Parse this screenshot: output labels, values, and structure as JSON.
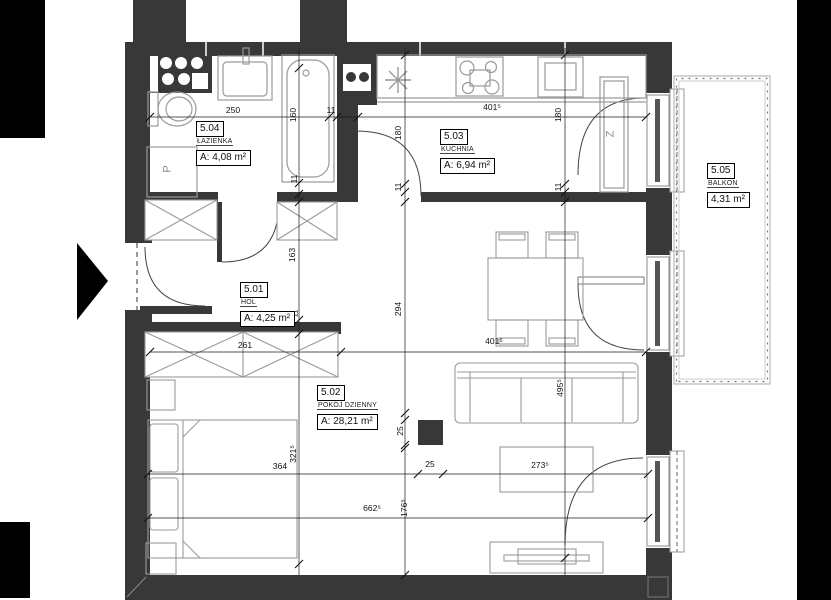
{
  "plan_title": "Apartment floor plan unit 5",
  "rooms": [
    {
      "id": "5.04",
      "name": "ŁAZIENKA",
      "area": "A: 4,08 m²"
    },
    {
      "id": "5.03",
      "name": "KUCHNIA",
      "area": "A: 6,94 m²"
    },
    {
      "id": "5.01",
      "name": "HOL",
      "area": "A: 4,25 m²"
    },
    {
      "id": "5.02",
      "name": "POKÓJ DZIENNY",
      "area": "A: 28,21 m²"
    },
    {
      "id": "5.05",
      "name": "BALKON",
      "area": "4,31 m²"
    }
  ],
  "dims": [
    "250",
    "11",
    "401⁵",
    "160",
    "11",
    "180",
    "11",
    "180",
    "11",
    "163",
    "294",
    "11",
    "261",
    "401⁵",
    "495⁵",
    "321⁵",
    "364",
    "25",
    "25",
    "273⁵",
    "176⁵",
    "662⁵"
  ],
  "annotations": {
    "washing_machine": "P",
    "fridge": "Z"
  },
  "colors": {
    "wall": "#383838",
    "frame_black": "#000000",
    "furniture_line": "#9a9a9a",
    "dim_line": "#1a1a1a"
  }
}
